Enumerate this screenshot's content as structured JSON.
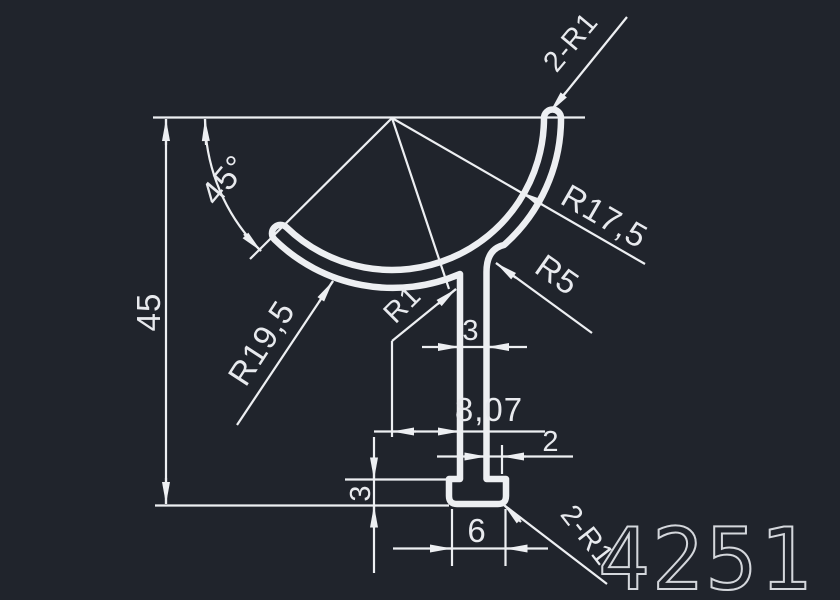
{
  "drawing": {
    "part_number": "4251",
    "dims": {
      "height": "45",
      "angle": "45°",
      "top_tip_radii": "2-R1",
      "radius_arc_top": "R17,5",
      "radius_fillet_right": "R5",
      "radius_arc_bottom": "R19,5",
      "radius_fillet_left": "R1",
      "stem_width": "3",
      "stem_offset": "8,07",
      "foot_step_right": "2",
      "foot_height": "3",
      "foot_width": "6",
      "bottom_corner_radii": "2-R1"
    }
  },
  "colors": {
    "background": "#20242c",
    "line": "#edeff2",
    "dim_text": "#e8eaee",
    "part_number_stroke": "#d4d7dc"
  }
}
